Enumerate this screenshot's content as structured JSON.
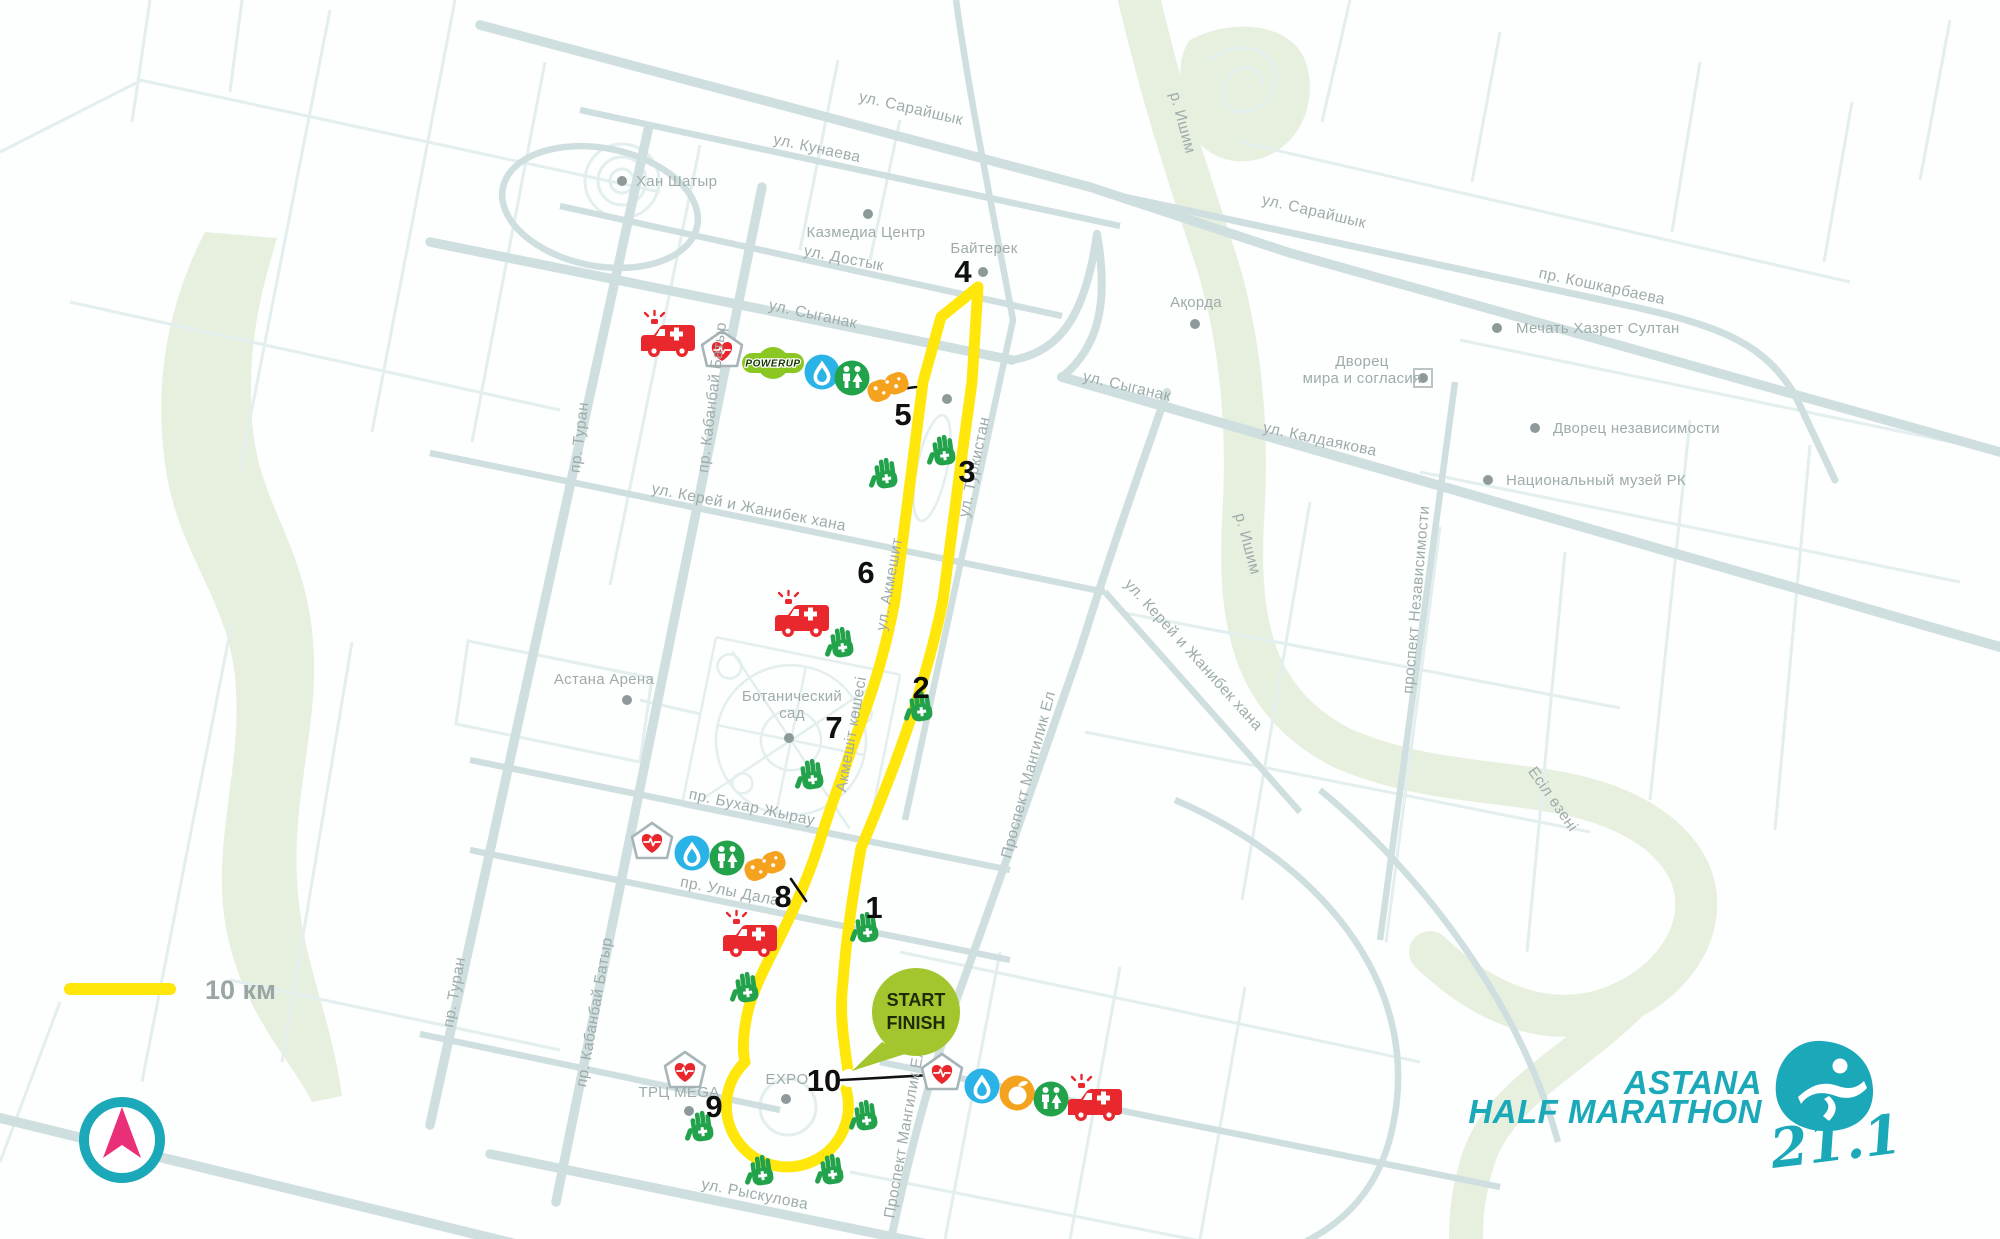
{
  "legend": {
    "distance_label": "10 км"
  },
  "start_finish": {
    "line1": "START",
    "line2": "FINISH"
  },
  "logo": {
    "title_line1": "ASTANA",
    "title_line2": "HALF MARATHON",
    "distance": "21.1"
  },
  "colors": {
    "route": "#ffe60b",
    "road": "#cfdfdf",
    "road_thin": "#e3eeee",
    "green": "#e7f0df",
    "label": "#9fabab",
    "teal": "#1ba9b9",
    "pink": "#ea2f79",
    "bubble": "#a3c62e",
    "red": "#e8282d",
    "hand_green": "#23a24c",
    "water_blue": "#29b3e6",
    "orange": "#f5a21f",
    "powerup_green": "#8bc722"
  },
  "map": {
    "street_labels": [
      {
        "text": "ул. Сарайшык",
        "x": 910,
        "y": 113,
        "rot": 13
      },
      {
        "text": "ул. Кунаева",
        "x": 816,
        "y": 153,
        "rot": 12
      },
      {
        "text": "ул. Достык",
        "x": 843,
        "y": 263,
        "rot": 11
      },
      {
        "text": "ул. Сыганак",
        "x": 812,
        "y": 319,
        "rot": 12
      },
      {
        "text": "ул. Сыганак",
        "x": 1126,
        "y": 391,
        "rot": 13
      },
      {
        "text": "ул. Сарайшык",
        "x": 1313,
        "y": 216,
        "rot": 13
      },
      {
        "text": "пр. Кошкарбаева",
        "x": 1601,
        "y": 291,
        "rot": 12
      },
      {
        "text": "ул. Калдаякова",
        "x": 1319,
        "y": 444,
        "rot": 12
      },
      {
        "text": "ул. Керей и Жанибек хана",
        "x": 748,
        "y": 512,
        "rot": 11
      },
      {
        "text": "ул. Керей и Жанибек хана",
        "x": 1190,
        "y": 658,
        "rot": 48
      },
      {
        "text": "пр. Бухар Жырау",
        "x": 751,
        "y": 812,
        "rot": 12
      },
      {
        "text": "пр. Улы Дала",
        "x": 729,
        "y": 896,
        "rot": 11
      },
      {
        "text": "ул. Рыскулова",
        "x": 754,
        "y": 1199,
        "rot": 11
      },
      {
        "text": "пр. Туран",
        "x": 584,
        "y": 438,
        "rot": -83
      },
      {
        "text": "пр. Туран",
        "x": 459,
        "y": 993,
        "rot": -80
      },
      {
        "text": "пр. Кабанбай Батыр",
        "x": 717,
        "y": 398,
        "rot": -83
      },
      {
        "text": "пр. Кабанбай Батыр",
        "x": 599,
        "y": 1013,
        "rot": -80
      },
      {
        "text": "ул. Акмешит",
        "x": 894,
        "y": 585,
        "rot": -80
      },
      {
        "text": "Акмешіт көшесі",
        "x": 856,
        "y": 735,
        "rot": -80
      },
      {
        "text": "ул. Туркистан",
        "x": 979,
        "y": 468,
        "rot": -78
      },
      {
        "text": "Проспект Мангилик Ел",
        "x": 1033,
        "y": 776,
        "rot": -75
      },
      {
        "text": "Проспект Мангилик Ел",
        "x": 909,
        "y": 1134,
        "rot": -80
      },
      {
        "text": "проспект Независимости",
        "x": 1421,
        "y": 600,
        "rot": -85
      },
      {
        "text": "р. Ишим",
        "x": 1178,
        "y": 124,
        "rot": 75
      },
      {
        "text": "р. Ишим",
        "x": 1243,
        "y": 545,
        "rot": 75
      },
      {
        "text": "Есіл өзені",
        "x": 1549,
        "y": 802,
        "rot": 55
      }
    ],
    "poi": [
      {
        "text": "Хан Шатыр",
        "x": 636,
        "y": 186,
        "anchor": "start",
        "dot": {
          "x": 622,
          "y": 181
        }
      },
      {
        "text": "Казмедиа Центр",
        "x": 866,
        "y": 237,
        "anchor": "middle",
        "dot": {
          "x": 868,
          "y": 214
        }
      },
      {
        "text": "Байтерек",
        "x": 984,
        "y": 253,
        "anchor": "middle",
        "dot": {
          "x": 983,
          "y": 272
        }
      },
      {
        "text": "Ақорда",
        "x": 1196,
        "y": 307,
        "anchor": "middle",
        "dot": {
          "x": 1195,
          "y": 324
        }
      },
      {
        "text": "Мечать Хазрет Султан",
        "x": 1516,
        "y": 333,
        "anchor": "start",
        "dot": {
          "x": 1497,
          "y": 328
        }
      },
      {
        "text": "Дворец\nмира и согласия",
        "x": 1362,
        "y": 366,
        "anchor": "middle",
        "dot": {
          "x": 1423,
          "y": 378
        },
        "boxed": true
      },
      {
        "text": "Дворец независимости",
        "x": 1553,
        "y": 433,
        "anchor": "start",
        "dot": {
          "x": 1535,
          "y": 428
        }
      },
      {
        "text": "Национальный музей РК",
        "x": 1506,
        "y": 485,
        "anchor": "start",
        "dot": {
          "x": 1488,
          "y": 480
        }
      },
      {
        "text": "Астана Арена",
        "x": 604,
        "y": 684,
        "anchor": "middle",
        "dot": {
          "x": 627,
          "y": 700
        }
      },
      {
        "text": "Ботанический\nсад",
        "x": 792,
        "y": 701,
        "anchor": "middle",
        "dot": {
          "x": 789,
          "y": 738
        }
      },
      {
        "text": "ТРЦ MEGA",
        "x": 679,
        "y": 1097,
        "anchor": "middle",
        "dot": {
          "x": 689,
          "y": 1111
        }
      },
      {
        "text": "EXPO",
        "x": 787,
        "y": 1084,
        "anchor": "middle",
        "dot": {
          "x": 786,
          "y": 1099
        }
      },
      {
        "text": "",
        "x": 947,
        "y": 399,
        "anchor": "middle",
        "dot": {
          "x": 947,
          "y": 399
        }
      }
    ],
    "km_markers": [
      {
        "n": "1",
        "x": 874,
        "y": 918
      },
      {
        "n": "2",
        "x": 921,
        "y": 698
      },
      {
        "n": "3",
        "x": 967,
        "y": 482
      },
      {
        "n": "4",
        "x": 963,
        "y": 282
      },
      {
        "n": "5",
        "x": 903,
        "y": 425
      },
      {
        "n": "6",
        "x": 866,
        "y": 583
      },
      {
        "n": "7",
        "x": 834,
        "y": 738
      },
      {
        "n": "8",
        "x": 783,
        "y": 907
      },
      {
        "n": "9",
        "x": 714,
        "y": 1117
      },
      {
        "n": "10",
        "x": 824,
        "y": 1091
      }
    ],
    "powerup_label": "POWERUP",
    "icons": [
      {
        "type": "ambulance",
        "x": 668,
        "y": 342
      },
      {
        "type": "ambulance",
        "x": 802,
        "y": 622
      },
      {
        "type": "ambulance",
        "x": 750,
        "y": 942
      },
      {
        "type": "ambulance",
        "x": 1095,
        "y": 1106
      },
      {
        "type": "medical-tent",
        "x": 722,
        "y": 350
      },
      {
        "type": "medical-tent",
        "x": 652,
        "y": 842
      },
      {
        "type": "medical-tent",
        "x": 685,
        "y": 1071
      },
      {
        "type": "medical-tent",
        "x": 942,
        "y": 1073
      },
      {
        "type": "powerup",
        "x": 773,
        "y": 363
      },
      {
        "type": "water",
        "x": 822,
        "y": 372
      },
      {
        "type": "water",
        "x": 692,
        "y": 853
      },
      {
        "type": "water",
        "x": 982,
        "y": 1086
      },
      {
        "type": "toilets",
        "x": 852,
        "y": 378
      },
      {
        "type": "toilets",
        "x": 727,
        "y": 858
      },
      {
        "type": "toilets",
        "x": 1051,
        "y": 1099
      },
      {
        "type": "sponge",
        "x": 888,
        "y": 387
      },
      {
        "type": "sponge",
        "x": 765,
        "y": 866
      },
      {
        "type": "fruit",
        "x": 1017,
        "y": 1093
      },
      {
        "type": "volunteer-hand",
        "x": 944,
        "y": 451
      },
      {
        "type": "volunteer-hand",
        "x": 886,
        "y": 474
      },
      {
        "type": "volunteer-hand",
        "x": 842,
        "y": 643
      },
      {
        "type": "volunteer-hand",
        "x": 921,
        "y": 707
      },
      {
        "type": "volunteer-hand",
        "x": 812,
        "y": 775
      },
      {
        "type": "volunteer-hand",
        "x": 867,
        "y": 928
      },
      {
        "type": "volunteer-hand",
        "x": 747,
        "y": 988
      },
      {
        "type": "volunteer-hand",
        "x": 702,
        "y": 1127
      },
      {
        "type": "volunteer-hand",
        "x": 866,
        "y": 1116
      },
      {
        "type": "volunteer-hand",
        "x": 762,
        "y": 1171
      },
      {
        "type": "volunteer-hand",
        "x": 832,
        "y": 1170
      }
    ]
  }
}
